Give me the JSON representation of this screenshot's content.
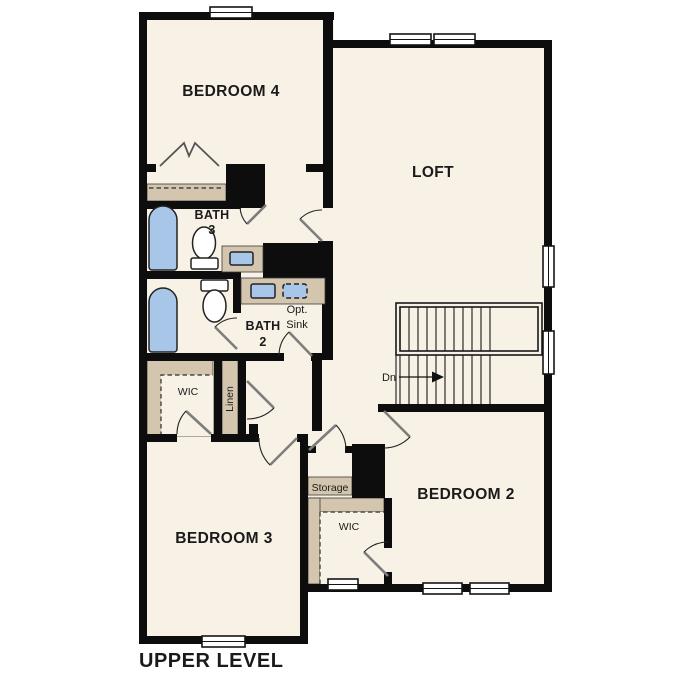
{
  "title": "UPPER LEVEL",
  "rooms": {
    "bedroom4": "BEDROOM 4",
    "loft": "LOFT",
    "bedroom2": "BEDROOM 2",
    "bedroom3": "BEDROOM 3"
  },
  "bath3": {
    "line1": "BATH",
    "line2": "3"
  },
  "bath2": {
    "line1": "BATH",
    "line2": "2"
  },
  "opt_sink": {
    "line1": "Opt.",
    "line2": "Sink"
  },
  "closets": {
    "wic_upper": "WIC",
    "wic_lower": "WIC",
    "linen": "Linen",
    "storage": "Storage"
  },
  "stairs": {
    "down_label": "Dn"
  },
  "colors": {
    "floor": "#f8f1e5",
    "wall": "#0d0d0d",
    "fixture": "#a8c7e8",
    "closet": "#d4c6ae",
    "background": "#ffffff"
  }
}
